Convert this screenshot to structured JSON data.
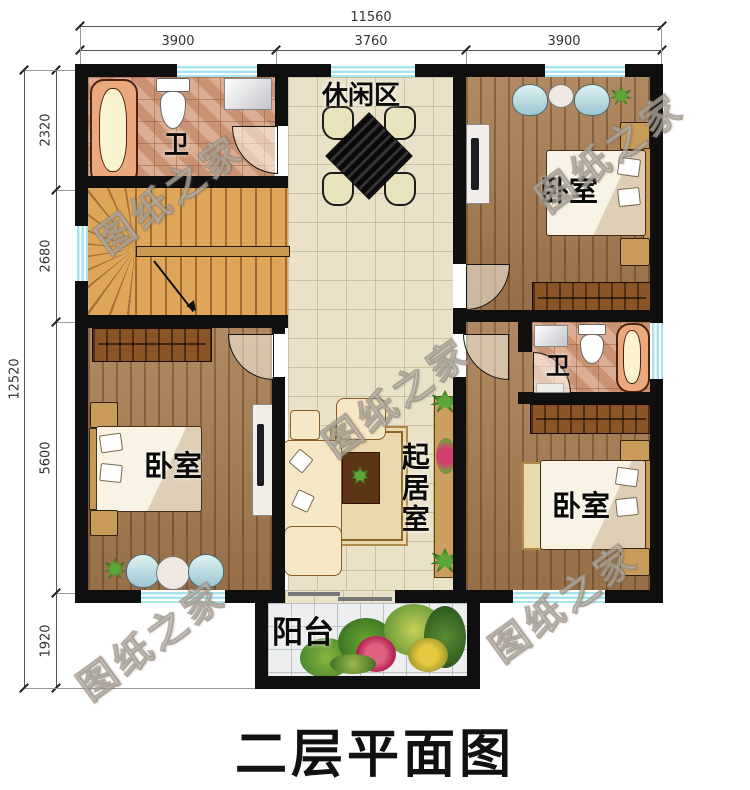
{
  "page": {
    "title": "二层平面图",
    "watermark": "图纸之家"
  },
  "dimensions": {
    "top": {
      "total": "11560",
      "segments": [
        "3900",
        "3760",
        "3900"
      ]
    },
    "left": {
      "total": "12520",
      "segments": [
        "2320",
        "2680",
        "5600",
        "1920"
      ]
    }
  },
  "rooms": {
    "leisure": "休闲区",
    "bath_top": "卫",
    "bedroom_top_right": "卧室",
    "bath_right": "卫",
    "bedroom_bottom_right": "卧室",
    "bedroom_bottom_left": "卧室",
    "living": "起居室",
    "balcony": "阳台"
  },
  "colors": {
    "wall": "#0f0f0f",
    "window": "#a8e4ec",
    "tile_floor": "#eae2c8",
    "wood_floor": "#a87c50",
    "stairs_wood": "#dfa65a",
    "bath_tile": "#d6a080",
    "balcony_tile": "#edeef0",
    "title_color": "#111111"
  }
}
